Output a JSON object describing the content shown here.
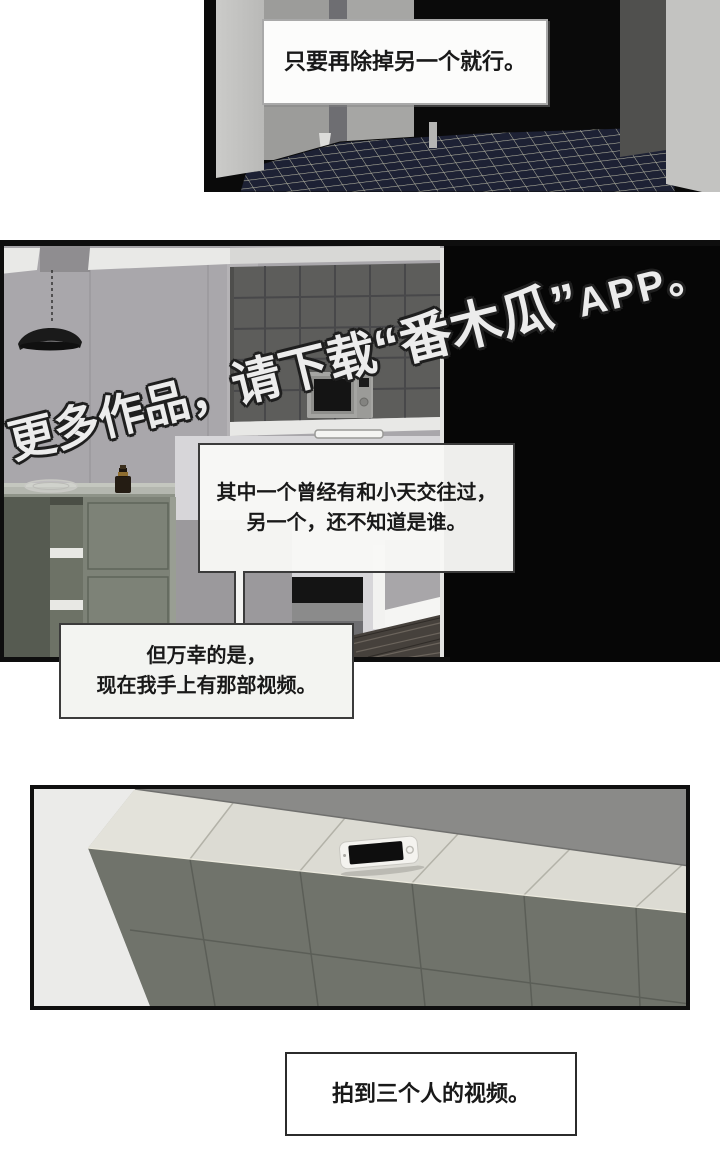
{
  "panel1": {
    "bubble_text": "只要再除掉另一个就行。"
  },
  "panel2": {
    "bubble1": {
      "line1": "其中一个曾经有和小天交往过，",
      "line2": "另一个，还不知道是谁。"
    },
    "bubble2": {
      "line1": "但万幸的是，",
      "line2": "现在我手上有那部视频。"
    },
    "watermark": {
      "seg1": "更多作品，",
      "seg2": "请下载",
      "seg3": "“番木瓜”",
      "seg4": "APP。"
    }
  },
  "caption": {
    "text": "拍到三个人的视频。"
  },
  "colors": {
    "speech_text": "#191919",
    "speech_border": "#3b3b3b",
    "watermark_fill": "#ececec",
    "watermark_outline": "#1f1f1f",
    "floor_tile": "#1d2134",
    "floor_grout": "#b7b7a4",
    "kitchen_wall": "#a9a7ab",
    "cabinet_tile": "#5d5d5b",
    "island_green": "#7d8277",
    "counter_top": "#dcdbd3",
    "counter_front": "#70736b"
  }
}
